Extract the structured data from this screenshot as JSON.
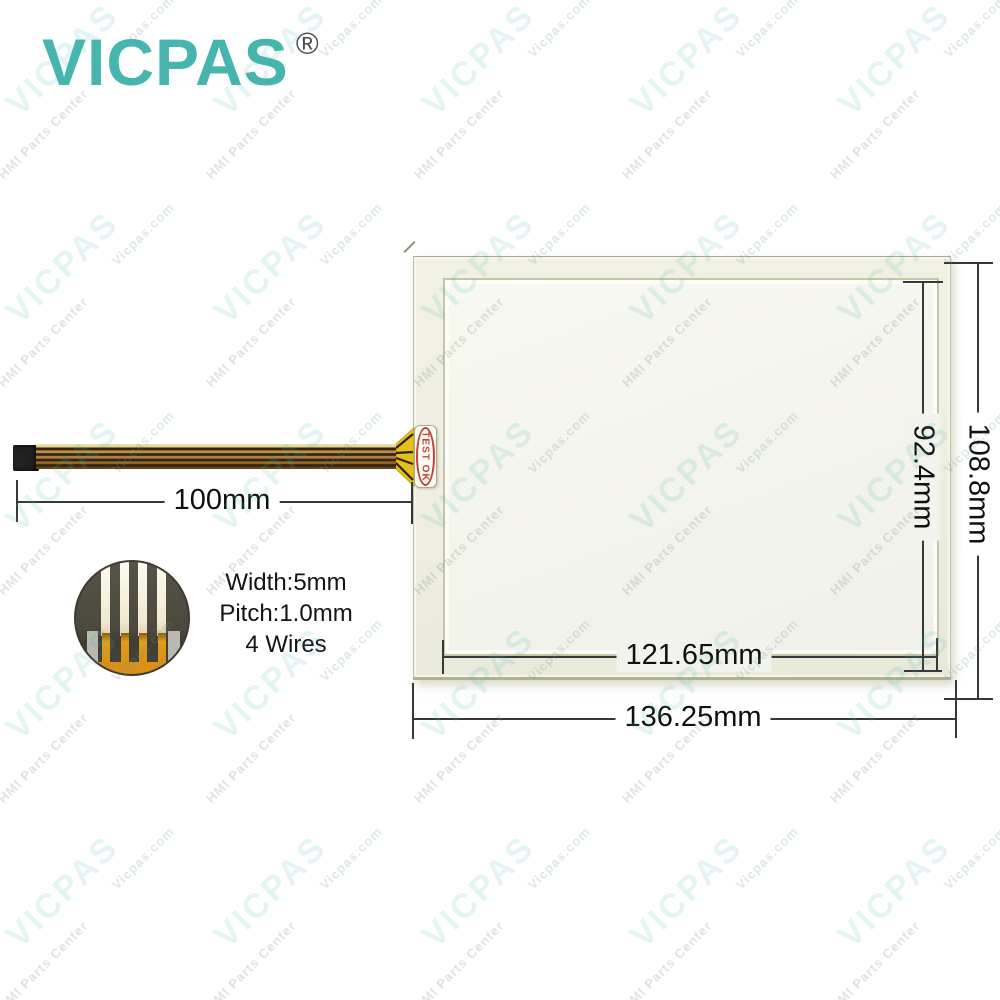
{
  "brand": {
    "logo_text": "VICPAS",
    "registered_mark": "®",
    "logo_color": "#45b5ad"
  },
  "watermark": {
    "primary": "VICPAS",
    "secondary": "HMI Parts Center",
    "tertiary": "Vicpas.com",
    "colors": {
      "primary": "rgba(69,181,173,0.15)",
      "secondary": "rgba(120,134,130,0.24)",
      "tertiary": "rgba(100,148,142,0.22)"
    },
    "grid": {
      "origin_x": 63,
      "origin_y": 60,
      "step_x": 208,
      "step_y": 208,
      "cols": 5,
      "rows": 5
    },
    "offsets": {
      "secondary_x": -20,
      "secondary_y": 74,
      "tertiary_x": 80,
      "tertiary_y": -34
    }
  },
  "product": {
    "test_label": "TEST OK",
    "connector_specs": [
      "Width:5mm",
      "Pitch:1.0mm",
      "4 Wires"
    ],
    "dimensions": {
      "cable_length": "100mm",
      "viewing_width": "121.65mm",
      "overall_width": "136.25mm",
      "viewing_height": "92.4mm",
      "overall_height": "108.8mm"
    }
  }
}
